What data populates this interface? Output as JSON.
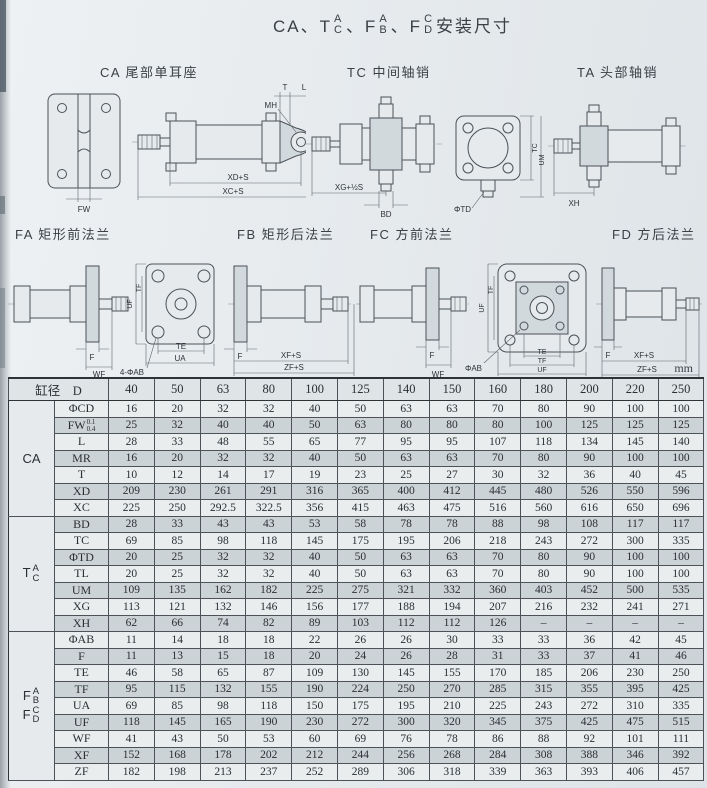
{
  "title": {
    "seg1": "CA、T",
    "stack1_top": "A",
    "stack1_bottom": "C",
    "seg2": "、F",
    "stack2_top": "A",
    "stack2_bottom": "B",
    "seg3": "、F",
    "stack3_top": "C",
    "stack3_bottom": "D",
    "suffix": " 安装尺寸"
  },
  "sections_row1": [
    {
      "label": "CA 尾部单耳座"
    },
    {
      "label": "TC 中间轴销"
    },
    {
      "label": "TA 头部轴销"
    }
  ],
  "sections_row2": [
    {
      "label": "FA 矩形前法兰"
    },
    {
      "label": "FB 矩形后法兰"
    },
    {
      "label": "FC 方前法兰"
    },
    {
      "label": "FD 方后法兰"
    }
  ],
  "diagram_dims": {
    "ca": [
      "T",
      "L",
      "MH",
      "FW",
      "XD+S",
      "XC+S"
    ],
    "tc": [
      "XG+½S",
      "BD",
      "ΦTD",
      "TC",
      "UM"
    ],
    "ta": [
      "XH"
    ],
    "fa": [
      "F",
      "WF",
      "UF",
      "TF",
      "TE",
      "UA",
      "4-ΦAB"
    ],
    "fb": [
      "F",
      "XF+S",
      "ZF+S"
    ],
    "fc": [
      "F",
      "WF",
      "UF",
      "TF",
      "TE",
      "TF",
      "UF",
      "ΦAB"
    ],
    "fd": [
      "F",
      "XF+S",
      "ZF+S"
    ]
  },
  "table": {
    "unit": "mm",
    "corner_label": "缸径　D",
    "sizes": [
      "40",
      "50",
      "63",
      "80",
      "100",
      "125",
      "140",
      "150",
      "160",
      "180",
      "200",
      "220",
      "250"
    ],
    "groups": [
      {
        "label": {
          "type": "plain",
          "main": "CA"
        },
        "rows": [
          {
            "dim": "ΦCD",
            "values": [
              "16",
              "20",
              "32",
              "32",
              "40",
              "50",
              "63",
              "63",
              "70",
              "80",
              "90",
              "100",
              "100"
            ]
          },
          {
            "dim": "FW",
            "tol_top": "0.1",
            "tol_bottom": "0.4",
            "values": [
              "25",
              "32",
              "40",
              "40",
              "50",
              "63",
              "80",
              "80",
              "80",
              "100",
              "125",
              "125",
              "125"
            ]
          },
          {
            "dim": "L",
            "values": [
              "28",
              "33",
              "48",
              "55",
              "65",
              "77",
              "95",
              "95",
              "107",
              "118",
              "134",
              "145",
              "140"
            ]
          },
          {
            "dim": "MR",
            "values": [
              "16",
              "20",
              "32",
              "32",
              "40",
              "50",
              "63",
              "63",
              "70",
              "80",
              "90",
              "100",
              "100"
            ]
          },
          {
            "dim": "T",
            "values": [
              "10",
              "12",
              "14",
              "17",
              "19",
              "23",
              "25",
              "27",
              "30",
              "32",
              "36",
              "40",
              "45"
            ]
          },
          {
            "dim": "XD",
            "values": [
              "209",
              "230",
              "261",
              "291",
              "316",
              "365",
              "400",
              "412",
              "445",
              "480",
              "526",
              "550",
              "596"
            ]
          },
          {
            "dim": "XC",
            "values": [
              "225",
              "250",
              "292.5",
              "322.5",
              "356",
              "415",
              "463",
              "475",
              "516",
              "560",
              "616",
              "650",
              "696"
            ]
          }
        ]
      },
      {
        "label": {
          "type": "stack",
          "main": "T",
          "top": "A",
          "bottom": "C"
        },
        "rows": [
          {
            "dim": "BD",
            "values": [
              "28",
              "33",
              "43",
              "43",
              "53",
              "58",
              "78",
              "78",
              "88",
              "98",
              "108",
              "117",
              "117"
            ]
          },
          {
            "dim": "TC",
            "values": [
              "69",
              "85",
              "98",
              "118",
              "145",
              "175",
              "195",
              "206",
              "218",
              "243",
              "272",
              "300",
              "335"
            ]
          },
          {
            "dim": "ΦTD",
            "values": [
              "20",
              "25",
              "32",
              "32",
              "40",
              "50",
              "63",
              "63",
              "70",
              "80",
              "90",
              "100",
              "100"
            ]
          },
          {
            "dim": "TL",
            "values": [
              "20",
              "25",
              "32",
              "32",
              "40",
              "50",
              "63",
              "63",
              "70",
              "80",
              "90",
              "100",
              "100"
            ]
          },
          {
            "dim": "UM",
            "values": [
              "109",
              "135",
              "162",
              "182",
              "225",
              "275",
              "321",
              "332",
              "360",
              "403",
              "452",
              "500",
              "535"
            ]
          },
          {
            "dim": "XG",
            "values": [
              "113",
              "121",
              "132",
              "146",
              "156",
              "177",
              "188",
              "194",
              "207",
              "216",
              "232",
              "241",
              "271"
            ]
          },
          {
            "dim": "XH",
            "values": [
              "62",
              "66",
              "74",
              "82",
              "89",
              "103",
              "112",
              "112",
              "126",
              "–",
              "–",
              "–",
              "–"
            ]
          }
        ]
      },
      {
        "label": {
          "type": "stack2",
          "parts": [
            {
              "main": "F",
              "top": "A",
              "bottom": "B"
            },
            {
              "main": "F",
              "top": "C",
              "bottom": "D"
            }
          ]
        },
        "rows": [
          {
            "dim": "ΦAB",
            "values": [
              "11",
              "14",
              "18",
              "18",
              "22",
              "26",
              "26",
              "30",
              "33",
              "33",
              "36",
              "42",
              "45"
            ]
          },
          {
            "dim": "F",
            "values": [
              "11",
              "13",
              "15",
              "18",
              "20",
              "24",
              "26",
              "28",
              "31",
              "33",
              "37",
              "41",
              "46"
            ]
          },
          {
            "dim": "TE",
            "values": [
              "46",
              "58",
              "65",
              "87",
              "109",
              "130",
              "145",
              "155",
              "170",
              "185",
              "206",
              "230",
              "250"
            ]
          },
          {
            "dim": "TF",
            "values": [
              "95",
              "115",
              "132",
              "155",
              "190",
              "224",
              "250",
              "270",
              "285",
              "315",
              "355",
              "395",
              "425"
            ]
          },
          {
            "dim": "UA",
            "values": [
              "69",
              "85",
              "98",
              "118",
              "150",
              "175",
              "195",
              "210",
              "225",
              "243",
              "272",
              "310",
              "335"
            ]
          },
          {
            "dim": "UF",
            "values": [
              "118",
              "145",
              "165",
              "190",
              "230",
              "272",
              "300",
              "320",
              "345",
              "375",
              "425",
              "475",
              "515"
            ]
          },
          {
            "dim": "WF",
            "values": [
              "41",
              "43",
              "50",
              "53",
              "60",
              "69",
              "76",
              "78",
              "86",
              "88",
              "92",
              "101",
              "111"
            ]
          },
          {
            "dim": "XF",
            "values": [
              "152",
              "168",
              "178",
              "202",
              "212",
              "244",
              "256",
              "268",
              "284",
              "308",
              "388",
              "346",
              "392"
            ]
          },
          {
            "dim": "ZF",
            "values": [
              "182",
              "198",
              "213",
              "237",
              "252",
              "289",
              "306",
              "318",
              "339",
              "363",
              "393",
              "406",
              "457"
            ]
          }
        ]
      }
    ]
  }
}
